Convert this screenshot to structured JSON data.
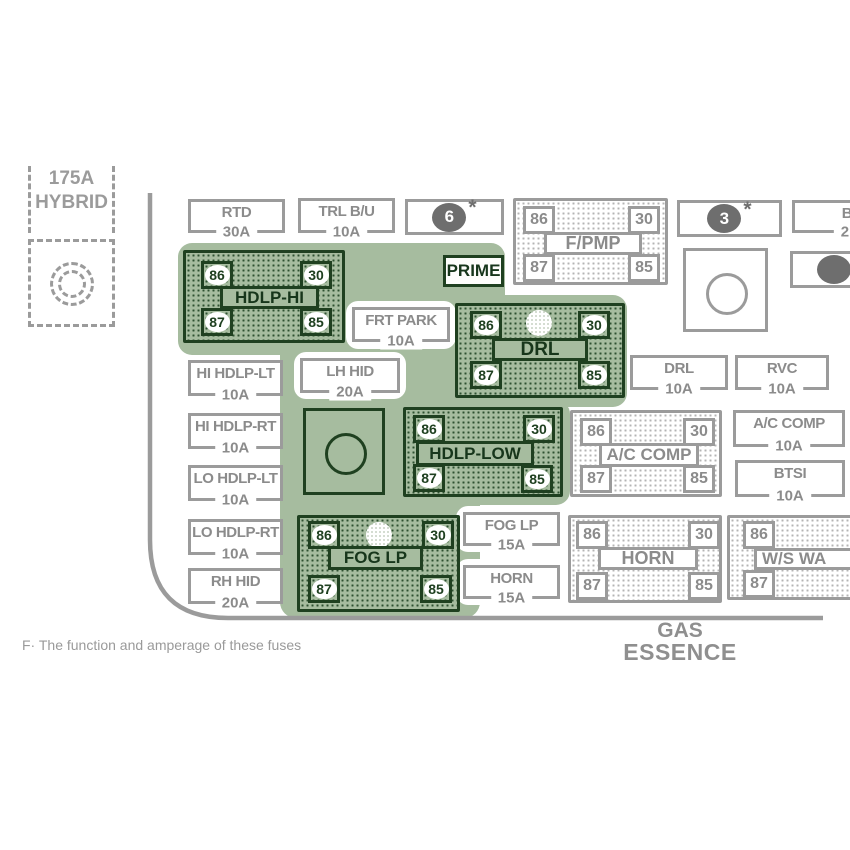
{
  "diagram_title": "Underhood fuse block diagram (cropped view)",
  "colors": {
    "highlight_green": "#a6bc9f",
    "dark_green": "#1f4020",
    "line_gray": "#9b9b9b",
    "text_gray": "#8b8b8b",
    "marker_gray": "#6e6e6e"
  },
  "hybrid": {
    "amp": "175A",
    "name": "HYBRID"
  },
  "prime": {
    "label": "PRIME"
  },
  "markers": {
    "oval6": "6",
    "oval3": "3",
    "asterisk": "*"
  },
  "fuses": {
    "rtd": {
      "name": "RTD",
      "amp": "30A"
    },
    "trl_bu": {
      "name": "TRL B/U",
      "amp": "10A"
    },
    "bu_partial": {
      "name": "B/",
      "amp": "2"
    },
    "frt_park": {
      "name": "FRT PARK",
      "amp": "10A"
    },
    "lh_hid": {
      "name": "LH HID",
      "amp": "20A"
    },
    "hi_hdlp_lt": {
      "name": "HI HDLP-LT",
      "amp": "10A"
    },
    "hi_hdlp_rt": {
      "name": "HI HDLP-RT",
      "amp": "10A"
    },
    "lo_hdlp_lt": {
      "name": "LO HDLP-LT",
      "amp": "10A"
    },
    "lo_hdlp_rt": {
      "name": "LO HDLP-RT",
      "amp": "10A"
    },
    "rh_hid": {
      "name": "RH HID",
      "amp": "20A"
    },
    "drl": {
      "name": "DRL",
      "amp": "10A"
    },
    "rvc": {
      "name": "RVC",
      "amp": "10A"
    },
    "ac_comp": {
      "name": "A/C COMP",
      "amp": "10A"
    },
    "btsi": {
      "name": "BTSI",
      "amp": "10A"
    },
    "fog_lp": {
      "name": "FOG LP",
      "amp": "15A"
    },
    "horn": {
      "name": "HORN",
      "amp": "15A"
    }
  },
  "relays": {
    "f_pmp": {
      "label": "F/PMP",
      "t86": "86",
      "t30": "30",
      "t87": "87",
      "t85": "85"
    },
    "hdlp_hi": {
      "label": "HDLP-HI",
      "t86": "86",
      "t30": "30",
      "t87": "87",
      "t85": "85"
    },
    "drl": {
      "label": "DRL",
      "t86": "86",
      "t30": "30",
      "t87": "87",
      "t85": "85"
    },
    "hdlp_low": {
      "label": "HDLP-LOW",
      "t86": "86",
      "t30": "30",
      "t87": "87",
      "t85": "85"
    },
    "fog_lp": {
      "label": "FOG LP",
      "t86": "86",
      "t30": "30",
      "t87": "87",
      "t85": "85"
    },
    "ac_comp": {
      "label": "A/C COMP",
      "t86": "86",
      "t30": "30",
      "t87": "87",
      "t85": "85"
    },
    "horn": {
      "label": "HORN",
      "t86": "86",
      "t30": "30",
      "t87": "87",
      "t85": "85"
    },
    "ws_wa": {
      "label": "W/S WA",
      "t86": "86",
      "t87": "87"
    }
  },
  "footer": {
    "gas": "GAS",
    "essence": "ESSENCE",
    "footnote": "F· The function and amperage of these fuses"
  }
}
